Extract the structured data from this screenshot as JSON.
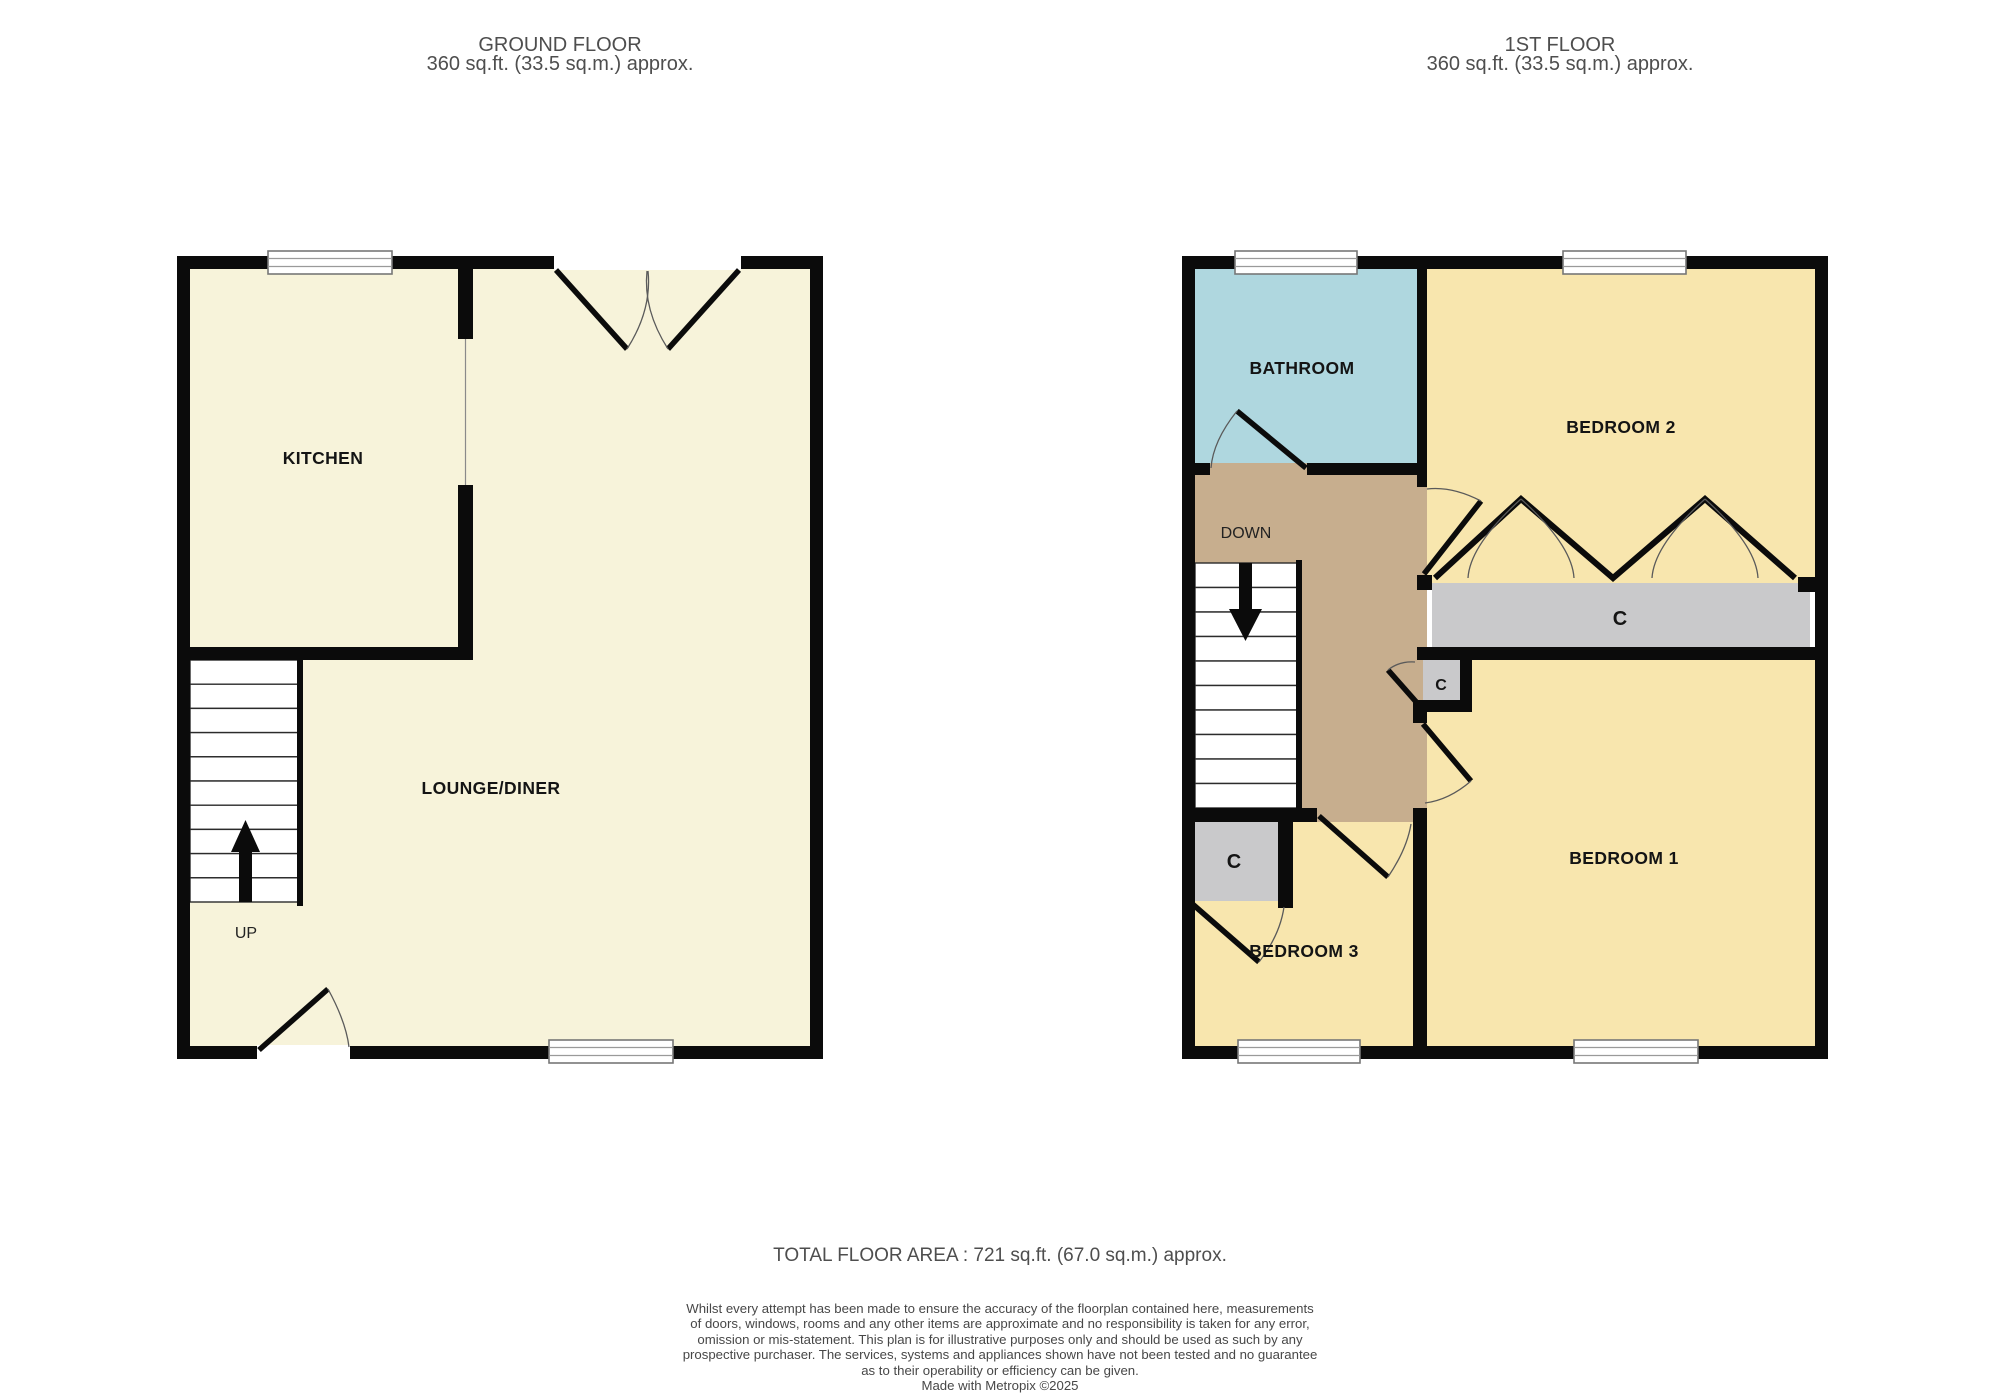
{
  "floors": {
    "ground": {
      "title": "GROUND FLOOR",
      "area": "360 sq.ft. (33.5 sq.m.) approx.",
      "rooms": {
        "kitchen": "KITCHEN",
        "lounge": "LOUNGE/DINER"
      },
      "stairs_label": "UP"
    },
    "first": {
      "title": "1ST FLOOR",
      "area": "360 sq.ft. (33.5 sq.m.) approx.",
      "rooms": {
        "bathroom": "BATHROOM",
        "bedroom2": "BEDROOM 2",
        "bedroom1": "BEDROOM 1",
        "bedroom3": "BEDROOM 3"
      },
      "closets": {
        "wardrobe": "C",
        "small": "C",
        "corner": "C"
      },
      "stairs_label": "DOWN"
    }
  },
  "footer": {
    "total_area": "TOTAL FLOOR AREA : 721 sq.ft. (67.0 sq.m.) approx.",
    "disclaimer_lines": [
      "Whilst every attempt has been made to ensure the accuracy of the floorplan contained here, measurements",
      "of doors, windows, rooms and any other items are approximate and no responsibility is taken for any error,",
      "omission or mis-statement. This plan is for illustrative purposes only and should be used as such by any",
      "prospective purchaser. The services, systems and appliances shown have not been tested and no guarantee",
      "as to their operability or efficiency can be given."
    ],
    "credit": "Made with Metropix ©2025"
  },
  "colors": {
    "floor_cream": "#f7f3da",
    "room_yellow": "#f8e6ae",
    "bathroom_blue": "#afd7df",
    "landing_tan": "#c7ae8e",
    "closet_gray": "#c9c9cb",
    "wall_black": "#0b0b0b",
    "label_text": "#141414",
    "muted_text": "#4e4e4e"
  }
}
